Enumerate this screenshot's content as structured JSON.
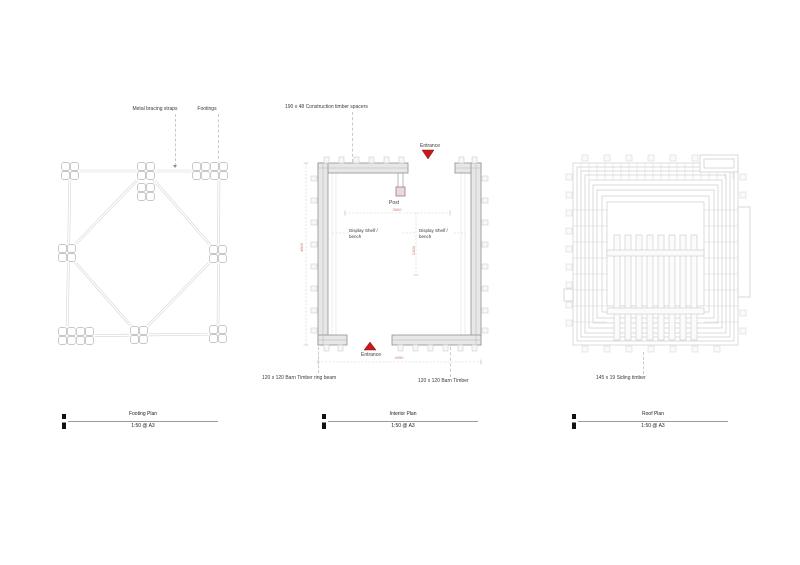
{
  "sheet": {
    "background": "#ffffff"
  },
  "colors": {
    "entrance_red": "#c41a1a",
    "dimension_red": "#cc7a6e",
    "line_gray": "#cccccc"
  },
  "footing_plan": {
    "title": "Footing Plan",
    "scale": "1:50 @ A3",
    "labels": {
      "metal_bracing_straps": "Metal bracing straps",
      "footings": "Footings"
    }
  },
  "interior_plan": {
    "title": "Interior Plan",
    "scale": "1:50 @ A3",
    "labels": {
      "construction_spacers": "190 x 48 Construction timber spacers",
      "entrance_top": "Entrance",
      "post": "Post",
      "display_shelf_line1": "Display Shelf /",
      "display_shelf_line2": "bench",
      "entrance_bottom": "Entrance",
      "ring_beam": "120 x 120 Barn Timber ring beam",
      "barn_timber": "120 x 120 Barn Timber"
    },
    "dimensions": {
      "inner_width": "3600",
      "left_height": "4800",
      "mid_height": "2400",
      "overall_width": "4050"
    }
  },
  "roof_plan": {
    "title": "Roof Plan",
    "scale": "1:50 @ A3",
    "labels": {
      "siding_timber": "145 x 19 Siding timber"
    }
  }
}
